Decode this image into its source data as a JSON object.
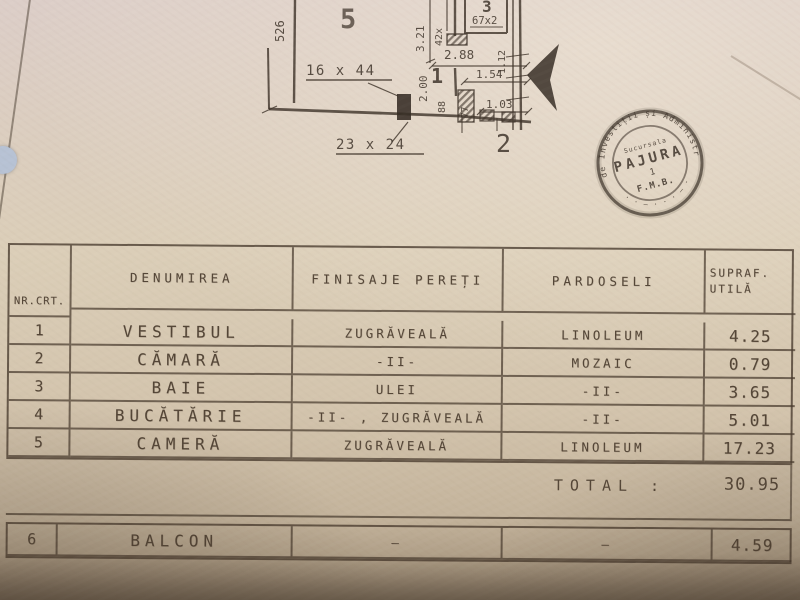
{
  "table": {
    "headers": [
      "NR.CRT.",
      "DENUMIREA",
      "FINISAJE PEREȚI",
      "PARDOSELI",
      "SUPRAF.\nUTILĂ"
    ],
    "rows": [
      {
        "nr": "1",
        "name": "VESTIBUL",
        "walls": "ZUGRĂVEALĂ",
        "floor": "LINOLEUM",
        "area": "4.25"
      },
      {
        "nr": "2",
        "name": "CĂMARĂ",
        "walls": "-II-",
        "floor": "MOZAIC",
        "area": "0.79"
      },
      {
        "nr": "3",
        "name": "BAIE",
        "walls": "ULEI",
        "floor": "-II-",
        "area": "3.65"
      },
      {
        "nr": "4",
        "name": "BUCĂTĂRIE",
        "walls": "-II- , ZUGRĂVEALĂ",
        "floor": "-II-",
        "area": "5.01"
      },
      {
        "nr": "5",
        "name": "CAMERĂ",
        "walls": "ZUGRĂVEALĂ",
        "floor": "LINOLEUM",
        "area": "17.23"
      }
    ],
    "total_label": "TOTAL :",
    "total_value": "30.95",
    "balcony_row": {
      "nr": "6",
      "name": "BALCON",
      "walls": "—",
      "floor": "—",
      "area": "4.59"
    }
  },
  "plan": {
    "room_labels": {
      "room5": "5",
      "room3": "3",
      "room1": "1",
      "room2": "2"
    },
    "dims": {
      "left_wall": "526",
      "v321": "3.21",
      "v42": "42x",
      "h288": "2.88",
      "win1": "16 x 44",
      "win2": "23 x 24",
      "room3_note": "67x2",
      "v200": "2.00",
      "v88": "88",
      "h154": "1.54",
      "v77": "77",
      "h103": "1.03",
      "v112": "1.12"
    }
  },
  "stamp": {
    "ring_text": "de Investiții și Administrație",
    "ring_text_bottom": "· · – · · · – · ·",
    "center_small": "Sucursala",
    "center_name": "PAJURA",
    "center_number": "1",
    "center_org": "F.M.B."
  }
}
